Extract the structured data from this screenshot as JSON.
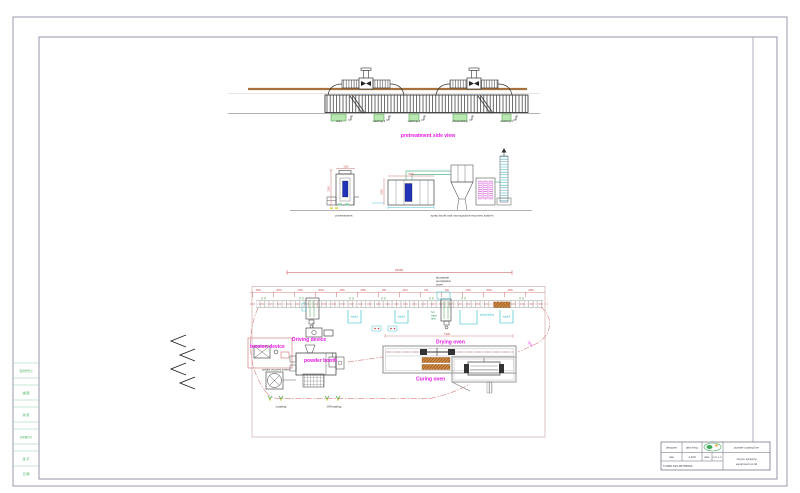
{
  "side_view": {
    "caption": "pretreatment side view",
    "tanks": [
      "skim",
      "washing 1",
      "washing 2",
      "phosphating",
      "washing 3"
    ]
  },
  "elevations": {
    "left_caption": "pretreatment",
    "right_caption": "spray booth and monocyclone recovery system",
    "dims": {
      "left_w": "1100",
      "left_h": "2260",
      "booth_w": "3200",
      "booth_h": "2350"
    }
  },
  "plan": {
    "overall_dim": "24050",
    "chain_dims": [
      "1500",
      "2570",
      "1700",
      "2000",
      "1450",
      "1500",
      "900",
      "1443",
      "140",
      "900",
      "1700",
      "2600",
      "1500",
      "2050"
    ],
    "tower": [
      "phosphate",
      "precipitation",
      "tower"
    ],
    "hot_tank": [
      "hot",
      "water",
      "tank"
    ],
    "tanks": [
      "wash1",
      "wash2",
      "phosphating",
      "wash3"
    ],
    "labels": {
      "tension": "tension device",
      "driving": "Driving device",
      "powder_booth": "powder booth",
      "recovery": "powder recovery system",
      "loading": "Loading",
      "offloading": "Off-loading",
      "drying": "Drying oven",
      "curing": "Curing oven"
    },
    "dims": {
      "drying_len": "7300",
      "approach": "7500"
    }
  },
  "margin_strip": {
    "cells": [
      "借用件登记",
      "描 图",
      "校 核",
      "旧底图总号",
      "签 字",
      "日 期"
    ]
  },
  "title_block": {
    "designer_label": "designer",
    "designer": "jake feng",
    "rate_label": "rate",
    "rate": "1:100",
    "date_label": "date",
    "date": "2021.6.17",
    "phone": "T:0086-523-86759666",
    "product": "powder coating line",
    "company1": "xinyue spraying",
    "company2": "equipment co.ltd"
  }
}
